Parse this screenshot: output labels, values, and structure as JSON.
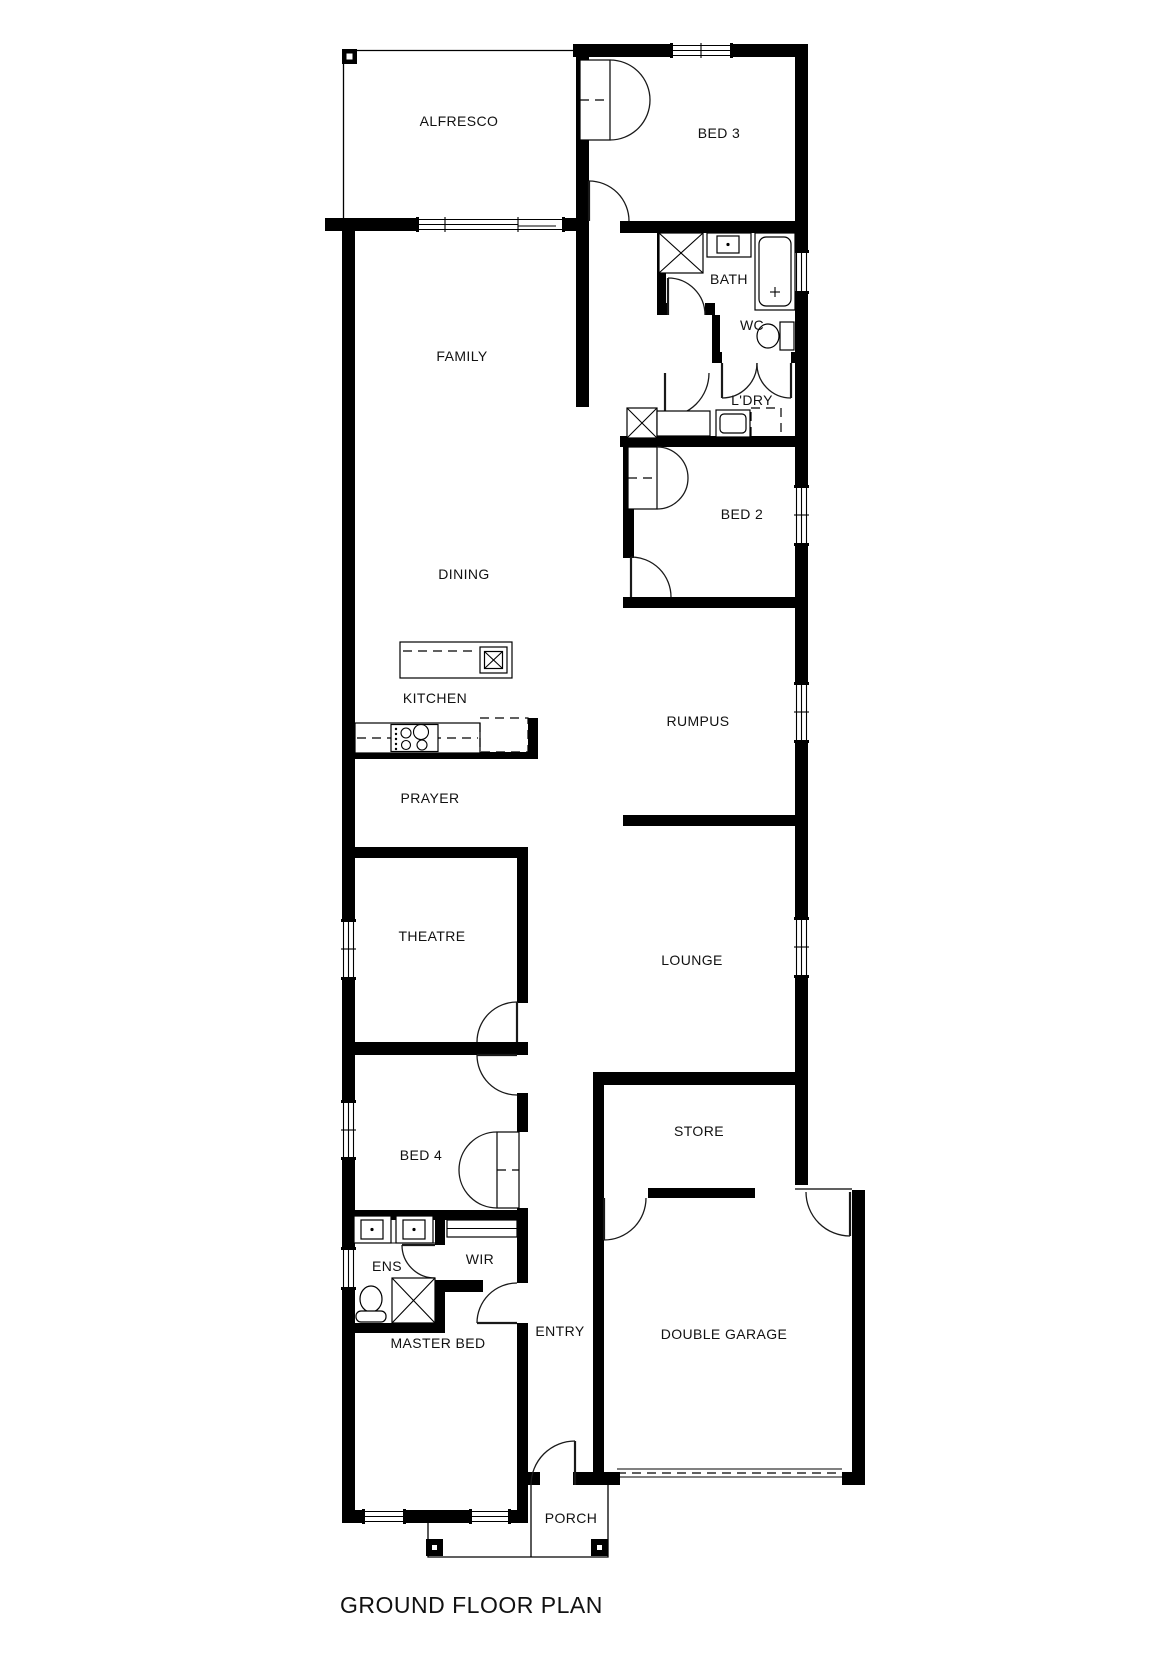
{
  "title": "GROUND FLOOR PLAN",
  "rooms": {
    "alfresco": "ALFRESCO",
    "bed3": "BED 3",
    "family": "FAMILY",
    "bath": "BATH",
    "wc": "WC",
    "ldry": "L'DRY",
    "bed2": "BED 2",
    "dining": "DINING",
    "kitchen": "KITCHEN",
    "rumpus": "RUMPUS",
    "prayer": "PRAYER",
    "theatre": "THEATRE",
    "lounge": "LOUNGE",
    "bed4": "BED 4",
    "store": "STORE",
    "ens": "ENS",
    "wir": "WIR",
    "master": "MASTER BED",
    "entry": "ENTRY",
    "garage": "DOUBLE GARAGE",
    "porch": "PORCH"
  },
  "colors": {
    "wall": "#000000",
    "background": "#ffffff",
    "text": "#111111"
  }
}
